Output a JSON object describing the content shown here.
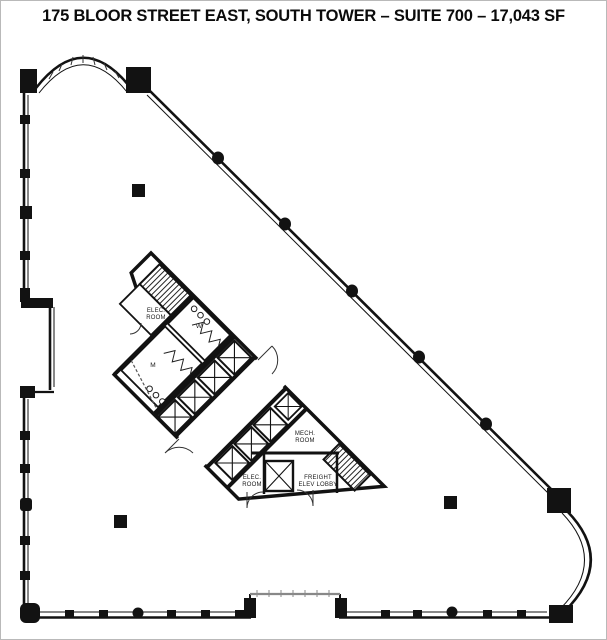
{
  "title": "175 BLOOR STREET EAST, SOUTH TOWER – SUITE 700 – 17,043 SF",
  "plan": {
    "labels": {
      "elec_room_upper_1": "ELEC.",
      "elec_room_upper_2": "ROOM",
      "washroom_w": "W",
      "washroom_m": "M",
      "mech_room_1": "MECH.",
      "mech_room_2": "ROOM",
      "elec_room_lower_1": "ELEC.",
      "elec_room_lower_2": "ROOM",
      "freight_lobby_1": "FREIGHT",
      "freight_lobby_2": "ELEV LOBBY"
    },
    "colors": {
      "wall": "#121212",
      "glass_line": "#444444",
      "recess_glass": "#888888"
    }
  }
}
